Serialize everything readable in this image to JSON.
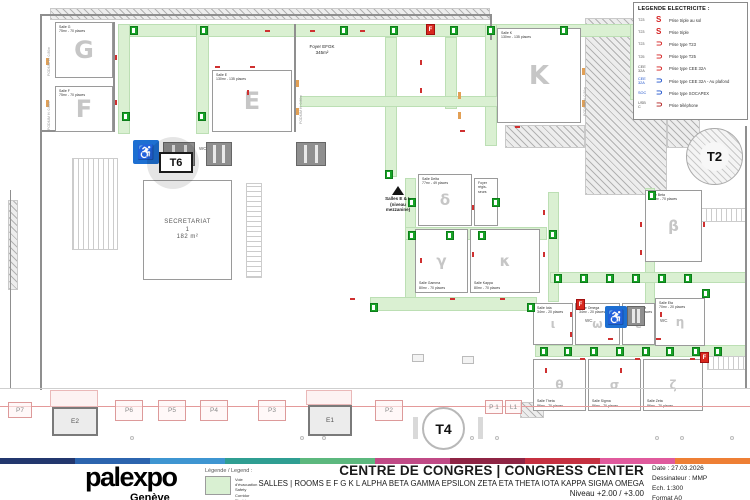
{
  "legend_electricite": {
    "title": "LEGENDE ELECTRICITE :",
    "items": [
      {
        "label": "T23",
        "symbol": "S",
        "color": "#d42020",
        "label_color": "#555555",
        "desc": "Prise triple au sol"
      },
      {
        "label": "T23",
        "symbol": "S",
        "color": "#d42020",
        "label_color": "#555555",
        "desc": "Prise triple"
      },
      {
        "label": "T23",
        "symbol": "⊃",
        "color": "#d42020",
        "label_color": "#555555",
        "desc": "Prise type T23"
      },
      {
        "label": "T25",
        "symbol": "⊃",
        "color": "#d42020",
        "label_color": "#555555",
        "desc": "Prise type T25"
      },
      {
        "label": "CEE\n32A",
        "symbol": "⊃",
        "color": "#d42020",
        "label_color": "#555555",
        "desc": "Prise type CEE 32A"
      },
      {
        "label": "CEE\n32A",
        "symbol": "⊃",
        "color": "#2255cc",
        "label_color": "#2255cc",
        "desc": "Prise type CEE 32A - Au plafond"
      },
      {
        "label": "SOC",
        "symbol": "⊃",
        "color": "#2255cc",
        "label_color": "#2255cc",
        "desc": "Prise type SOCAPEX"
      },
      {
        "label": "USB\nC",
        "symbol": "⊃",
        "color": "#b02020",
        "label_color": "#555555",
        "desc": "Prise téléphone"
      }
    ]
  },
  "footer": {
    "logo": "palexpo",
    "logo_sub": "Genève",
    "legend_title": "Légende / Legend :",
    "legend_lines": "Voie d'évacuation\nSafety Corridor\nFluchtweg",
    "title": "CENTRE DE CONGRES | CONGRESS CENTER",
    "subtitle": "SALLES | ROOMS E F G K L ALPHA BETA GAMMA EPSILON ZETA ETA THETA IOTA KAPPA SIGMA OMEGA",
    "level": "Niveau +2.00 / +3.00",
    "date": "Date : 27.03.2026",
    "drafter": "Dessinateur : MMP",
    "scale": "Ech. 1:300",
    "format": "Format A0",
    "strip_colors": [
      "#23376e",
      "#2c64ae",
      "#3e95d1",
      "#2f9e92",
      "#5cb87e",
      "#c04a86",
      "#8e2444",
      "#c53040",
      "#e05a9d",
      "#ee7f35"
    ]
  },
  "markers": {
    "t6": "T6",
    "t2": "T2",
    "t4": "T4"
  },
  "plan": {
    "colors": {
      "corridor": "#daf0d2",
      "exit": "#17a327",
      "access_blue": "#1d6fd1",
      "fire_red": "#d8281e",
      "facade_line": "#e49a9a"
    },
    "rooms": [
      {
        "name": "room-g",
        "letter": "G",
        "x": 55,
        "y": 22,
        "w": 58,
        "h": 56,
        "fs": 24,
        "label": "Salle G\n75m² - 70 places",
        "lpos": "top"
      },
      {
        "name": "room-f",
        "letter": "F",
        "x": 55,
        "y": 86,
        "w": 58,
        "h": 46,
        "fs": 24,
        "label": "Salle F\n75m² - 70 places",
        "lpos": "top"
      },
      {
        "name": "room-e",
        "letter": "E",
        "x": 212,
        "y": 70,
        "w": 80,
        "h": 62,
        "fs": 24,
        "label": "Salle E\n130m² - 135 places",
        "lpos": "top"
      },
      {
        "name": "room-k",
        "letter": "K",
        "x": 497,
        "y": 28,
        "w": 84,
        "h": 95,
        "fs": 26,
        "label": "Salle K\n130m² - 135 places",
        "lpos": "top"
      },
      {
        "name": "room-secretariat",
        "letter": "",
        "x": 143,
        "y": 180,
        "w": 89,
        "h": 100,
        "fs": 0,
        "label": "SECRETARIAT\n1\n182 m²",
        "lpos": "center"
      },
      {
        "name": "room-delta",
        "letter": "δ",
        "x": 418,
        "y": 174,
        "w": 54,
        "h": 52,
        "fs": 15,
        "label": "Salle Delta\n77m² - 49 places",
        "lpos": "top"
      },
      {
        "name": "room-foyer-regisseurs",
        "letter": "",
        "x": 474,
        "y": 178,
        "w": 24,
        "h": 48,
        "fs": 0,
        "label": "Foyer\nrégis-\nseurs",
        "lpos": "top"
      },
      {
        "name": "room-gamma",
        "letter": "γ",
        "x": 415,
        "y": 229,
        "w": 53,
        "h": 64,
        "fs": 15,
        "label": "Salle Gamma\n80m² - 70 places",
        "lpos": "bottom"
      },
      {
        "name": "room-kappa",
        "letter": "κ",
        "x": 470,
        "y": 229,
        "w": 70,
        "h": 64,
        "fs": 15,
        "label": "Salle Kappa\n80m² - 70 places",
        "lpos": "bottom"
      },
      {
        "name": "room-beta",
        "letter": "β",
        "x": 645,
        "y": 190,
        "w": 57,
        "h": 72,
        "fs": 15,
        "label": "Salle Beta\n100m² - 70 places",
        "lpos": "top"
      },
      {
        "name": "room-iota",
        "letter": "ι",
        "x": 533,
        "y": 303,
        "w": 40,
        "h": 42,
        "fs": 12,
        "label": "Salle Iota\n34m² - 20 places",
        "lpos": "top"
      },
      {
        "name": "room-omega",
        "letter": "ω",
        "x": 575,
        "y": 303,
        "w": 45,
        "h": 42,
        "fs": 12,
        "label": "Salle Omega\n34m² - 20 places",
        "lpos": "top"
      },
      {
        "name": "room-epsilon",
        "letter": "ε",
        "x": 622,
        "y": 303,
        "w": 33,
        "h": 42,
        "fs": 12,
        "label": "Salle Epsilon\n34m² - 20 places",
        "lpos": "top"
      },
      {
        "name": "room-eta",
        "letter": "η",
        "x": 655,
        "y": 298,
        "w": 50,
        "h": 48,
        "fs": 12,
        "label": "Salle Eta\n70m² - 20 places",
        "lpos": "top"
      },
      {
        "name": "room-theta",
        "letter": "θ",
        "x": 533,
        "y": 359,
        "w": 53,
        "h": 52,
        "fs": 12,
        "label": "Salle Theta\n86m² - 70 places",
        "lpos": "bottom"
      },
      {
        "name": "room-sigma",
        "letter": "σ",
        "x": 588,
        "y": 359,
        "w": 53,
        "h": 52,
        "fs": 12,
        "label": "Salle Sigma\n86m² - 70 places",
        "lpos": "bottom"
      },
      {
        "name": "room-zeta",
        "letter": "ζ",
        "x": 643,
        "y": 359,
        "w": 60,
        "h": 52,
        "fs": 12,
        "label": "Salle Zeta\n86m² - 70 places",
        "lpos": "bottom"
      }
    ],
    "corridors": [
      [
        118,
        24,
        524,
        13
      ],
      [
        118,
        24,
        12,
        110
      ],
      [
        196,
        24,
        13,
        110
      ],
      [
        385,
        37,
        12,
        140
      ],
      [
        445,
        37,
        12,
        72
      ],
      [
        485,
        24,
        12,
        122
      ],
      [
        300,
        96,
        198,
        11
      ],
      [
        405,
        178,
        11,
        120
      ],
      [
        405,
        227,
        142,
        13
      ],
      [
        370,
        297,
        167,
        14
      ],
      [
        548,
        192,
        11,
        110
      ],
      [
        645,
        188,
        10,
        118
      ],
      [
        550,
        272,
        196,
        11
      ],
      [
        535,
        345,
        212,
        12
      ],
      [
        630,
        24,
        13,
        76
      ]
    ],
    "hatches": [
      [
        50,
        8,
        440,
        12
      ],
      [
        585,
        18,
        82,
        177
      ],
      [
        667,
        18,
        33,
        130
      ],
      [
        505,
        125,
        80,
        23
      ],
      [
        8,
        200,
        10,
        90
      ],
      [
        520,
        402,
        24,
        16
      ]
    ],
    "walls": [
      [
        40,
        14,
        2,
        376
      ],
      [
        40,
        14,
        452,
        2
      ],
      [
        490,
        14,
        2,
        26
      ],
      [
        745,
        126,
        2,
        262
      ],
      [
        294,
        24,
        2,
        108
      ],
      [
        113,
        22,
        2,
        110
      ],
      [
        10,
        190,
        1,
        198
      ],
      [
        42,
        130,
        73,
        2
      ]
    ],
    "exits": [
      [
        130,
        26
      ],
      [
        200,
        26
      ],
      [
        340,
        26
      ],
      [
        390,
        26
      ],
      [
        450,
        26
      ],
      [
        487,
        26
      ],
      [
        560,
        26
      ],
      [
        634,
        92
      ],
      [
        122,
        112
      ],
      [
        198,
        112
      ],
      [
        385,
        170
      ],
      [
        408,
        198
      ],
      [
        408,
        231
      ],
      [
        446,
        231
      ],
      [
        478,
        231
      ],
      [
        492,
        198
      ],
      [
        370,
        303
      ],
      [
        527,
        303
      ],
      [
        549,
        230
      ],
      [
        648,
        191
      ],
      [
        554,
        274
      ],
      [
        580,
        274
      ],
      [
        606,
        274
      ],
      [
        632,
        274
      ],
      [
        658,
        274
      ],
      [
        684,
        274
      ],
      [
        702,
        289
      ],
      [
        540,
        347
      ],
      [
        564,
        347
      ],
      [
        590,
        347
      ],
      [
        616,
        347
      ],
      [
        642,
        347
      ],
      [
        666,
        347
      ],
      [
        692,
        347
      ],
      [
        714,
        347
      ]
    ],
    "outlets_v": [
      [
        115,
        55
      ],
      [
        115,
        100
      ],
      [
        420,
        60
      ],
      [
        420,
        88
      ],
      [
        472,
        205
      ],
      [
        472,
        252
      ],
      [
        543,
        210
      ],
      [
        543,
        252
      ],
      [
        420,
        258
      ],
      [
        640,
        222
      ],
      [
        640,
        250
      ],
      [
        703,
        222
      ],
      [
        570,
        312
      ],
      [
        570,
        332
      ],
      [
        545,
        368
      ],
      [
        620,
        368
      ],
      [
        660,
        312
      ],
      [
        247,
        90
      ]
    ],
    "outlets_h": [
      [
        265,
        30
      ],
      [
        310,
        30
      ],
      [
        360,
        30
      ],
      [
        215,
        66
      ],
      [
        250,
        66
      ],
      [
        460,
        130
      ],
      [
        515,
        126
      ],
      [
        350,
        298
      ],
      [
        450,
        298
      ],
      [
        500,
        298
      ],
      [
        580,
        358
      ],
      [
        635,
        358
      ],
      [
        690,
        358
      ],
      [
        608,
        338
      ],
      [
        656,
        338
      ]
    ],
    "orange_marks": [
      [
        46,
        58
      ],
      [
        46,
        100
      ],
      [
        296,
        80
      ],
      [
        296,
        108
      ],
      [
        582,
        68
      ],
      [
        582,
        100
      ],
      [
        458,
        92
      ],
      [
        458,
        112
      ]
    ],
    "stairs": [
      {
        "x": 72,
        "y": 158,
        "w": 46,
        "h": 92,
        "dir": "v"
      },
      {
        "x": 246,
        "y": 183,
        "w": 16,
        "h": 95,
        "dir": "h"
      },
      {
        "x": 707,
        "y": 356,
        "w": 40,
        "h": 14,
        "dir": "v"
      },
      {
        "x": 700,
        "y": 208,
        "w": 46,
        "h": 14,
        "dir": "v"
      }
    ],
    "lifts": [
      [
        163,
        142,
        32,
        24
      ],
      [
        206,
        142,
        26,
        24
      ],
      [
        296,
        142,
        30,
        24
      ],
      [
        627,
        306,
        18,
        20
      ]
    ],
    "access_badges": [
      [
        133,
        140,
        26,
        24
      ],
      [
        605,
        306,
        22,
        22
      ]
    ],
    "access_glyph": "♿",
    "wc_labels": [
      {
        "x": 199,
        "y": 146,
        "text": "WC"
      },
      {
        "x": 585,
        "y": 318,
        "text": "WC"
      },
      {
        "x": 660,
        "y": 318,
        "text": "WC"
      }
    ],
    "fire_label": "F",
    "fire_positions": [
      [
        426,
        24
      ],
      [
        576,
        299
      ],
      [
        700,
        352
      ]
    ],
    "mezzanine_note": {
      "x": 368,
      "y": 196,
      "w": 60,
      "text": "Salles E & L\n(niveau\nmezzanine)",
      "tri_x": 392,
      "tri_y": 186
    },
    "foyer_note": {
      "x": 302,
      "y": 44,
      "w": 40,
      "text": "Foyer EFGK\n345m²"
    },
    "vtexts": [
      {
        "x": 47,
        "y": 76,
        "text": "PODIUM H: 0.80m"
      },
      {
        "x": 47,
        "y": 130,
        "text": "PODIUM H: 0.80m"
      },
      {
        "x": 299,
        "y": 124,
        "text": "PODIUM H: 0.80m"
      },
      {
        "x": 583,
        "y": 116,
        "text": "PODIUM H: 0.80m"
      }
    ],
    "t6": {
      "cx": 147,
      "cy": 137,
      "d": 52,
      "bx": 159,
      "by": 152,
      "bw": 30,
      "bh": 17
    },
    "t2": {
      "cx": 686,
      "cy": 128,
      "d": 57,
      "fs": 13
    },
    "t4": {
      "cx": 422,
      "cy": 407,
      "d": 43,
      "fs": 14
    },
    "gates": [
      {
        "label": "P7",
        "x": 8,
        "y": 402,
        "w": 24,
        "h": 16
      },
      {
        "label": "P6",
        "x": 115,
        "y": 400,
        "w": 28,
        "h": 21
      },
      {
        "label": "P5",
        "x": 158,
        "y": 400,
        "w": 28,
        "h": 21
      },
      {
        "label": "P4",
        "x": 200,
        "y": 400,
        "w": 28,
        "h": 21
      },
      {
        "label": "P3",
        "x": 258,
        "y": 400,
        "w": 28,
        "h": 21
      },
      {
        "label": "P2",
        "x": 375,
        "y": 400,
        "w": 28,
        "h": 21
      },
      {
        "label": "P 1",
        "x": 485,
        "y": 400,
        "w": 18,
        "h": 14
      },
      {
        "label": "L1",
        "x": 505,
        "y": 400,
        "w": 17,
        "h": 14
      }
    ],
    "doors": [
      {
        "label": "E2",
        "ox": 50,
        "oy": 390,
        "ow": 48,
        "oh": 17,
        "bx": 52,
        "by": 407,
        "bw": 46,
        "bh": 29
      },
      {
        "label": "E1",
        "ox": 306,
        "oy": 390,
        "ow": 46,
        "oh": 15,
        "bx": 308,
        "by": 405,
        "bw": 44,
        "bh": 31
      }
    ],
    "grey_line": [
      0,
      388,
      750,
      1
    ],
    "red_line": [
      0,
      406,
      750,
      1
    ],
    "dots_y": 436,
    "dots_x": [
      130,
      300,
      322,
      470,
      495,
      655,
      680,
      730
    ],
    "pillars": [
      [
        413,
        417,
        5,
        22
      ],
      [
        478,
        417,
        5,
        22
      ]
    ],
    "small_rects": [
      [
        412,
        354,
        12,
        8
      ],
      [
        462,
        356,
        12,
        8
      ]
    ]
  }
}
